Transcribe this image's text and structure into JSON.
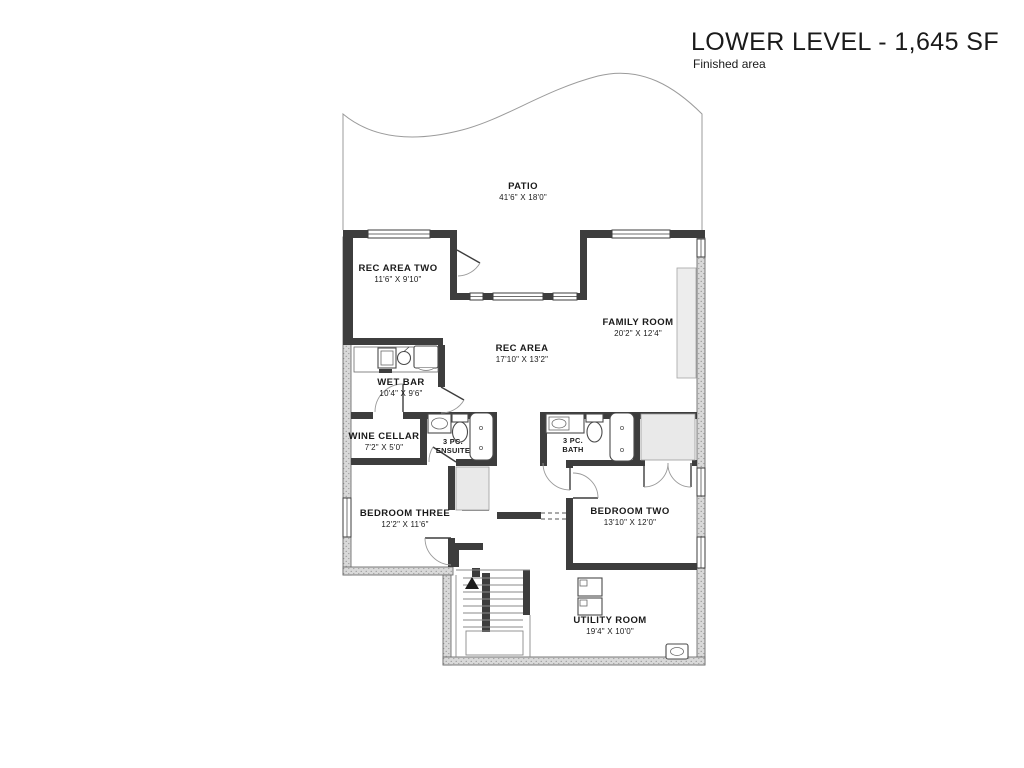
{
  "header": {
    "title": "LOWER LEVEL  - 1,645 SF",
    "subtitle": "Finished area"
  },
  "rooms": [
    {
      "id": "patio",
      "line1": "PATIO",
      "line2": "41'6\" X 18'0\""
    },
    {
      "id": "rec-area-two",
      "line1": "REC AREA TWO",
      "line2": "11'6\" X 9'10\""
    },
    {
      "id": "family-room",
      "line1": "FAMILY ROOM",
      "line2": "20'2\" X 12'4\""
    },
    {
      "id": "rec-area",
      "line1": "REC AREA",
      "line2": "17'10\" X 13'2\""
    },
    {
      "id": "wet-bar",
      "line1": "WET BAR",
      "line2": "10'4\" X 9'6\""
    },
    {
      "id": "wine-cellar",
      "line1": "WINE CELLAR",
      "line2": "7'2\" X 5'0\""
    },
    {
      "id": "ensuite",
      "line1": "3 PC.",
      "line2": "ENSUITE"
    },
    {
      "id": "bath",
      "line1": "3 PC.",
      "line2": "BATH"
    },
    {
      "id": "bedroom-three",
      "line1": "BEDROOM THREE",
      "line2": "12'2\" X 11'6\""
    },
    {
      "id": "bedroom-two",
      "line1": "BEDROOM TWO",
      "line2": "13'10\" X 12'0\""
    },
    {
      "id": "utility-room",
      "line1": "UTILITY ROOM",
      "line2": "19'4\" X 10'0\""
    }
  ],
  "colors": {
    "wall_color": "#3d3d3d",
    "foundation_color": "#d9d9d9",
    "line_color": "#8a8a8a",
    "text_color": "#1a1a1a"
  }
}
